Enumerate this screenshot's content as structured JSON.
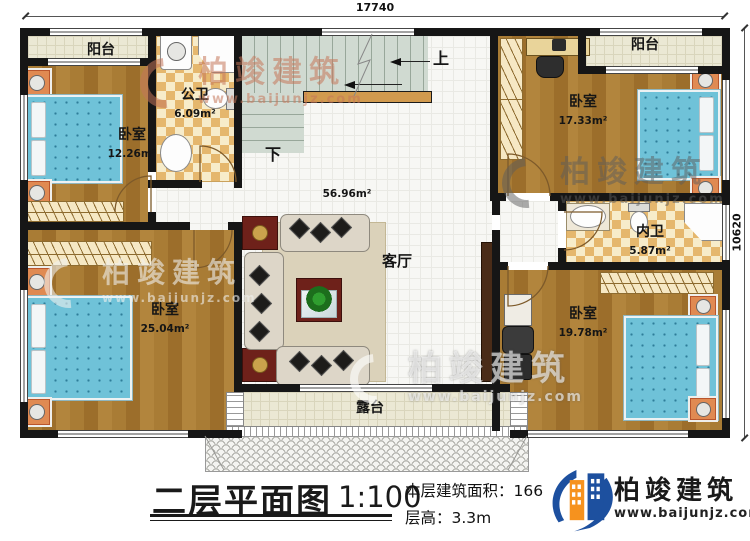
{
  "plan": {
    "dim_top": "17740",
    "dim_right": "10620",
    "stair_up": "上",
    "stair_down": "下",
    "living_area": "56.96m²",
    "rooms": {
      "balcony_left": {
        "label": "阳台"
      },
      "balcony_right": {
        "label": "阳台"
      },
      "bedroom_top_left": {
        "label": "卧室",
        "area": "12.26m²"
      },
      "bath_public": {
        "label": "公卫",
        "area": "6.09m²"
      },
      "bedroom_top_right": {
        "label": "卧室",
        "area": "17.33m²"
      },
      "bath_inner": {
        "label": "内卫",
        "area": "5.87m²"
      },
      "living": {
        "label": "客厅"
      },
      "bedroom_bottom_left": {
        "label": "卧室",
        "area": "25.04m²"
      },
      "bedroom_bottom_right": {
        "label": "卧室",
        "area": "19.78m²"
      },
      "terrace": {
        "label": "露台"
      }
    }
  },
  "watermark": {
    "brand": "柏竣建筑",
    "url": "www.baijunjz.com"
  },
  "titleblock": {
    "title": "二层平面图",
    "scale": "1:100",
    "area_line": "本层建筑面积：166.6㎡",
    "height_line": "层高：3.3m",
    "brand": "柏竣建筑",
    "brand_url": "www.baijunjz.com"
  }
}
